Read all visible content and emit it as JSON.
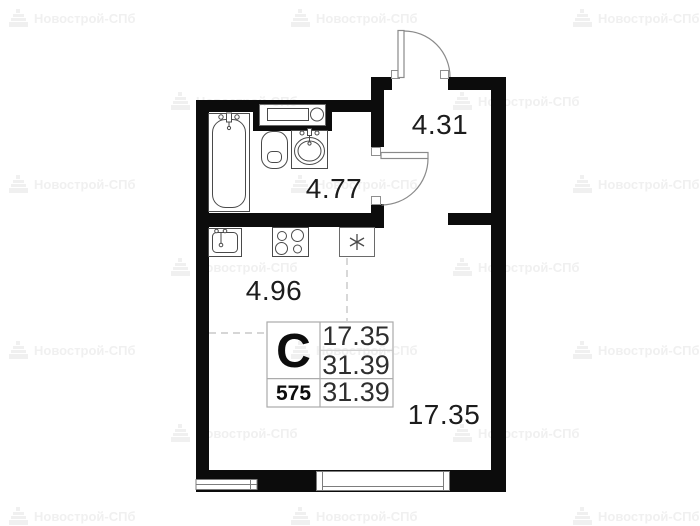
{
  "watermark": {
    "label": "Новострой-СПб"
  },
  "plan": {
    "dimensions": {
      "hallway": "4.31",
      "bathroom": "4.77",
      "kitchen": "4.96",
      "living_room": "17.35"
    },
    "info_table": {
      "apartment_type": "С",
      "living_area": "17.35",
      "total_area": "31.39",
      "unit_number": "575",
      "total_area_repeat": "31.39"
    }
  }
}
